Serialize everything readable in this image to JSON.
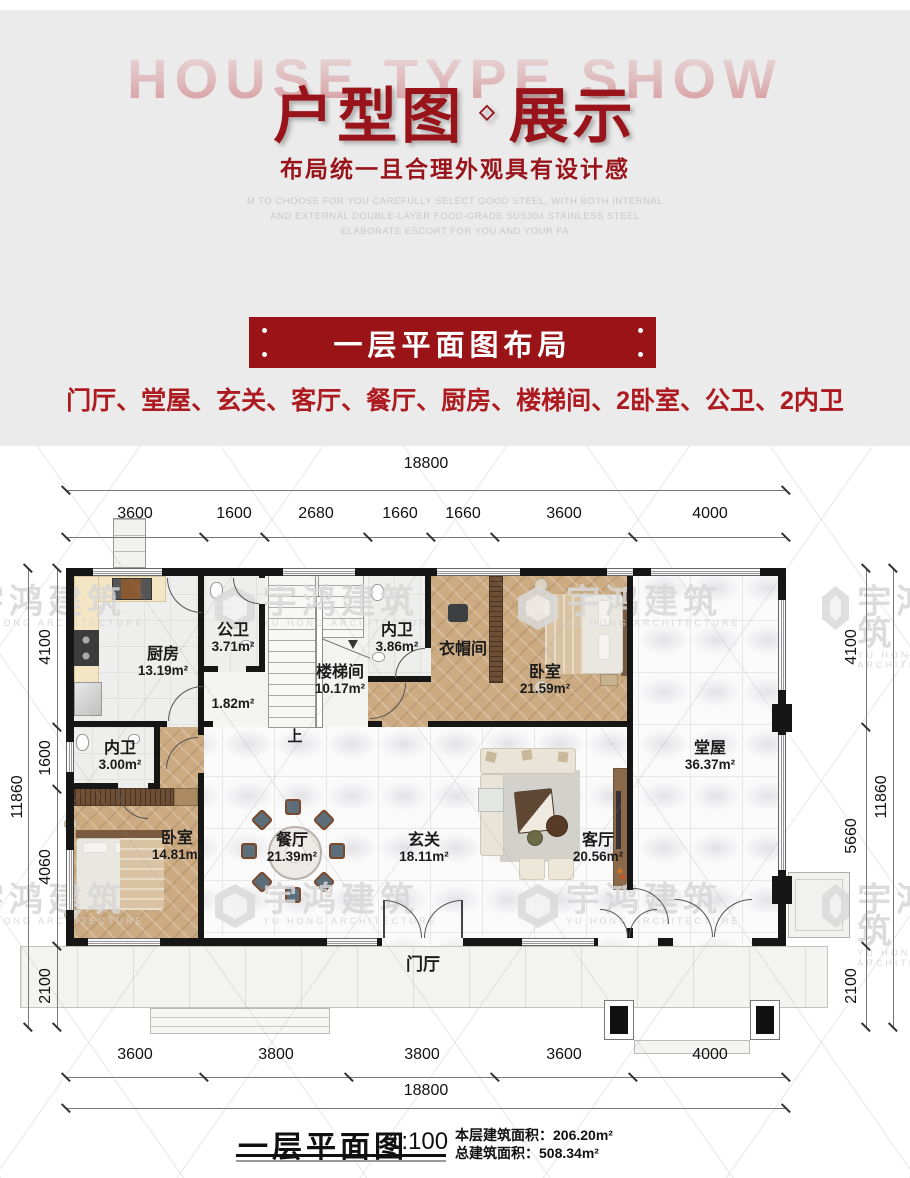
{
  "header": {
    "bg_text": "HOUSE TYPE SHOW",
    "title_left": "户型图",
    "title_diamond": "◇",
    "title_right": "展示",
    "subtitle": "布局统一且合理外观具有设计感",
    "desc_line1": "M TO CHOOSE FOR YOU CAREFULLY SELECT GOOD STEEL, WITH BOTH INTERNAL",
    "desc_line2": "AND EXTERNAL DOUBLE-LAYER FOOD-GRADE SUS304 STAINLESS STEEL",
    "desc_line3": "ELABORATE ESCORT FOR YOU AND YOUR FA"
  },
  "section": {
    "banner": "一层平面图布局",
    "room_list": "门厅、堂屋、玄关、客厅、餐厅、厨房、楼梯间、2卧室、公卫、2内卫"
  },
  "plan": {
    "dims": {
      "top_total": "18800",
      "top": [
        "3600",
        "1600",
        "2680",
        "1660",
        "1660",
        "3600",
        "4000"
      ],
      "bottom": [
        "3600",
        "3800",
        "3800",
        "3600",
        "4000"
      ],
      "bottom_total": "18800",
      "left_total": "11860",
      "left": [
        "4100",
        "1600",
        "4060",
        "2100"
      ],
      "right": [
        "4100",
        "5660",
        "2100"
      ],
      "right_total": "11860"
    },
    "rooms": {
      "kitchen": {
        "name": "厨房",
        "area": "13.19m²"
      },
      "public_bath": {
        "name": "公卫",
        "area": "3.71m²"
      },
      "hall_nook": {
        "area": "1.82m²"
      },
      "stairwell": {
        "name": "楼梯间",
        "area": "10.17m²"
      },
      "inner_bath_1": {
        "name": "内卫",
        "area": "3.86m²"
      },
      "cloakroom": {
        "name": "衣帽间"
      },
      "bedroom_1": {
        "name": "卧室",
        "area": "21.59m²"
      },
      "main_hall": {
        "name": "堂屋",
        "area": "36.37m²"
      },
      "inner_bath_2": {
        "name": "内卫",
        "area": "3.00m²"
      },
      "bedroom_2": {
        "name": "卧室",
        "area": "14.81m²"
      },
      "dining": {
        "name": "餐厅",
        "area": "21.39m²"
      },
      "foyer": {
        "name": "玄关",
        "area": "18.11m²"
      },
      "living": {
        "name": "客厅",
        "area": "20.56m²"
      },
      "porch": {
        "name": "门厅"
      },
      "stair_up": "上"
    },
    "watermark": {
      "cn": "宇鸿建筑",
      "en": "YU HONG ARCHITECTURE"
    }
  },
  "caption": {
    "title": "一层平面图",
    "scale": "1:100",
    "floor_area_label": "本层建筑面积：",
    "floor_area_value": "206.20m²",
    "total_area_label": "总建筑面积：",
    "total_area_value": "508.34m²"
  },
  "colors": {
    "accent_red": "#99141a",
    "banner_red": "#991317",
    "list_red": "#ad1b20",
    "wall_black": "#161616",
    "wood": "#cdab82"
  }
}
